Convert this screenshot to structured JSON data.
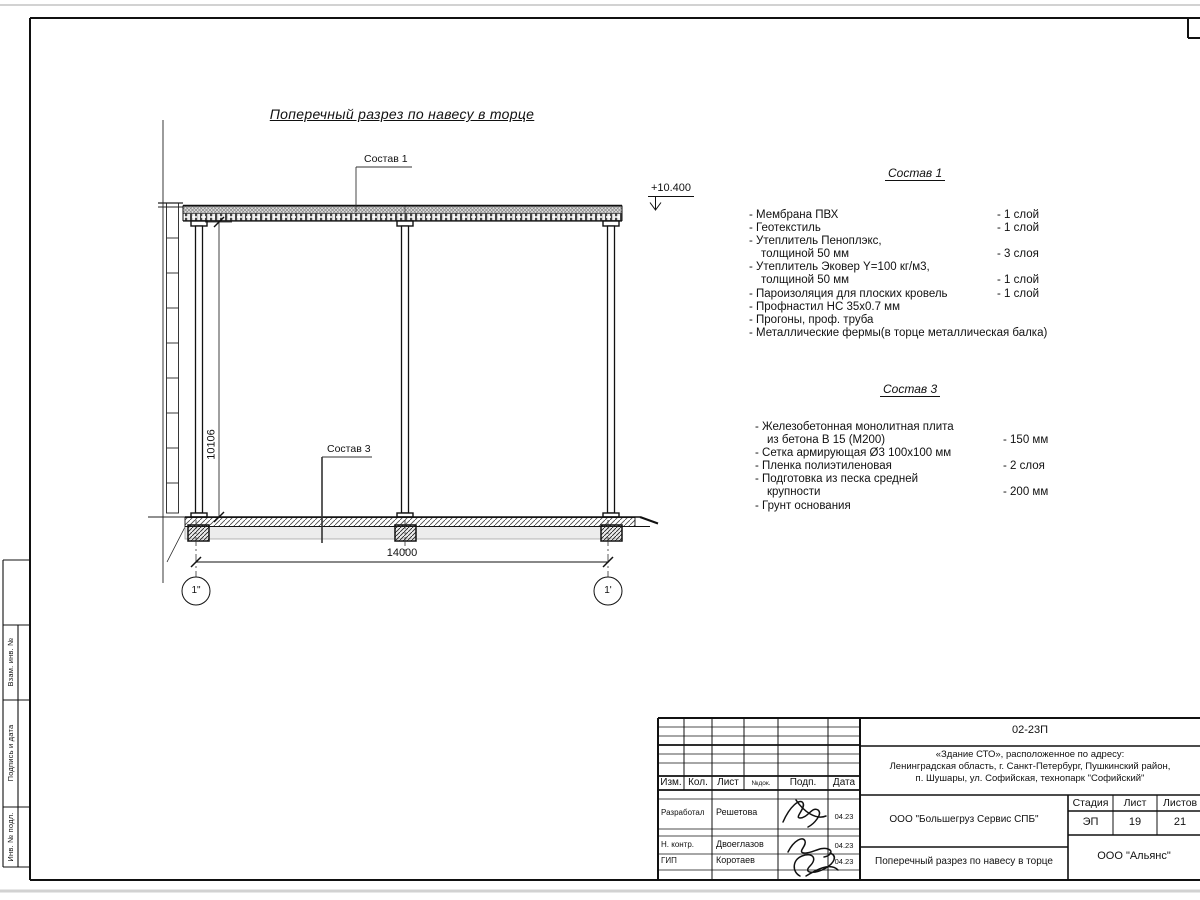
{
  "drawing": {
    "title": "Поперечный разрез по навесу в торце",
    "elevation": "+10.400",
    "leader1": "Состав 1",
    "leader3": "Состав 3",
    "dim_width": "14000",
    "dim_height": "10106",
    "axis_left": "1\"",
    "axis_right": "1'"
  },
  "sostav1": {
    "heading": "Состав 1",
    "items": [
      {
        "name": "- Мембрана ПВХ",
        "qty": "- 1 слой"
      },
      {
        "name": "- Геотекстиль",
        "qty": "- 1 слой"
      },
      {
        "name": "- Утеплитель Пеноплэкс,\nтолщиной 50 мм",
        "qty": "- 3 слоя"
      },
      {
        "name": "- Утеплитель Эковер Y=100 кг/м3,\nтолщиной 50 мм",
        "qty": "- 1 слой"
      },
      {
        "name": "- Пароизоляция для плоских кровель",
        "qty": "- 1 слой"
      },
      {
        "name": "- Профнастил НС 35х0.7 мм",
        "qty": ""
      },
      {
        "name": "- Прогоны, проф. труба",
        "qty": ""
      },
      {
        "name": "- Металлические фермы(в торце металлическая балка)",
        "qty": ""
      }
    ]
  },
  "sostav3": {
    "heading": "Состав 3",
    "items": [
      {
        "name": "- Железобетонная  монолитная плита\nиз бетона В 15 (М200)",
        "qty": "- 150 мм"
      },
      {
        "name": "- Сетка армирующая Ø3 100х100 мм",
        "qty": ""
      },
      {
        "name": "- Пленка полиэтиленовая",
        "qty": "-  2 слоя"
      },
      {
        "name": "- Подготовка из песка средней\nкрупности",
        "qty": "- 200 мм"
      },
      {
        "name": "- Грунт основания",
        "qty": ""
      }
    ]
  },
  "titleblock": {
    "code": "02-23П",
    "address_lines": [
      "«Здание СТО», расположенное по адресу:",
      "Ленинградская область, г. Санкт-Петербург, Пушкинский район,",
      "п. Шушары, ул. Софийская, технопарк \"Софийский\""
    ],
    "org": "ООО \"Большегруз Сервис СПБ\"",
    "doc_title": "Поперечный разрез по навесу в торце",
    "org2": "ООО \"Альянс\"",
    "stage_label": "Стадия",
    "sheet_label": "Лист",
    "sheets_label": "Листов",
    "stage": "ЭП",
    "sheet": "19",
    "sheets": "21",
    "cols": [
      "Изм.",
      "Кол.",
      "Лист",
      "№док.",
      "Подп.",
      "Дата"
    ],
    "rows": [
      {
        "role": "Разработал",
        "name": "Решетова",
        "date": "04.23"
      },
      {
        "role": "Н. контр.",
        "name": "Двоеглазов",
        "date": "04.23"
      },
      {
        "role": "ГИП",
        "name": "Коротаев",
        "date": "04.23"
      }
    ]
  },
  "side_stamp": {
    "labels": [
      "Взам. инв. №",
      "Подпись и дата",
      "Инв. № подл."
    ]
  }
}
